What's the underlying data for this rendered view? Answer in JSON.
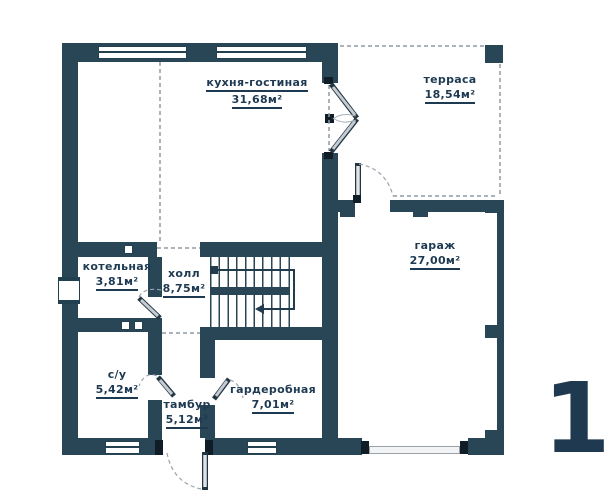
{
  "plan": {
    "title": "first-floor-plan",
    "floor_number": "1",
    "rooms": {
      "kitchen_living": {
        "name": "кухня-гостиная",
        "area": "31,68м²"
      },
      "terrace": {
        "name": "терраса",
        "area": "18,54м²"
      },
      "garage": {
        "name": "гараж",
        "area": "27,00м²"
      },
      "boiler": {
        "name": "котельная",
        "area": "3,81м²"
      },
      "hall": {
        "name": "холл",
        "area": "8,75м²"
      },
      "bathroom": {
        "name": "с/у",
        "area": "5,42м²"
      },
      "vestibule": {
        "name": "тамбур",
        "area": "5,12м²"
      },
      "wardrobe": {
        "name": "гардеробная",
        "area": "7,01м²"
      }
    },
    "colors": {
      "wall": "#284656",
      "text": "#1e3a52",
      "dash": "#8f9ba4",
      "door_leaf": "#c5cbd0",
      "jamb": "#101c26"
    }
  }
}
